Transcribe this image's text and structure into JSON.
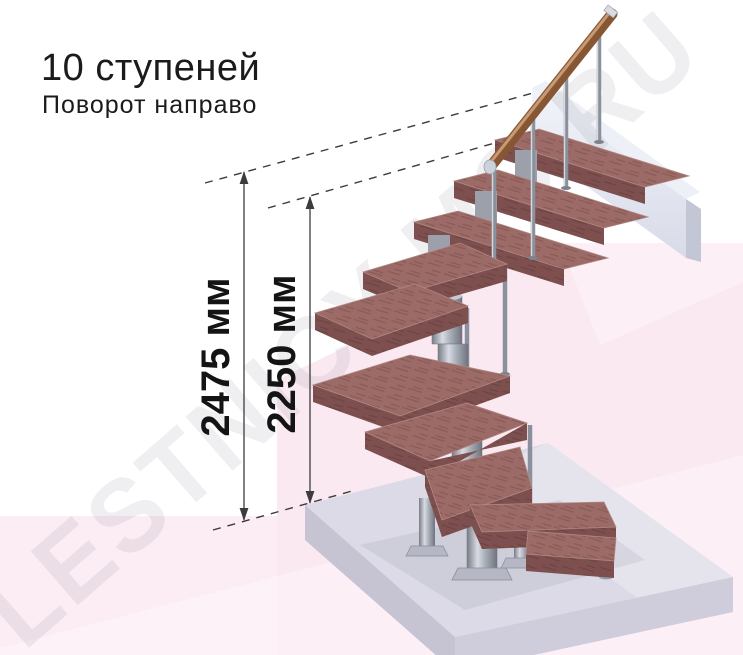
{
  "title": {
    "heading": "10 ступеней",
    "subheading": "Поворот направо"
  },
  "dimensions": {
    "overall_height": "2475 мм",
    "height_to_top_step": "2250 мм"
  },
  "watermark": "LESTNICY-MO.RU",
  "stair": {
    "steps": 10,
    "turn_direction": "направо",
    "type": "модульная лестница с поворотом"
  },
  "colors": {
    "step_top": "#9c6b67",
    "step_front": "#7d504f",
    "metal": "#9aa0ab",
    "handrail": "#8a5a38",
    "floor_slab": "#dcdae6",
    "upper_beam": "#e6e8f1",
    "background_pink": "#fbe9f2",
    "dimension_ink": "#3c3c3c",
    "text_ink": "#141414"
  }
}
